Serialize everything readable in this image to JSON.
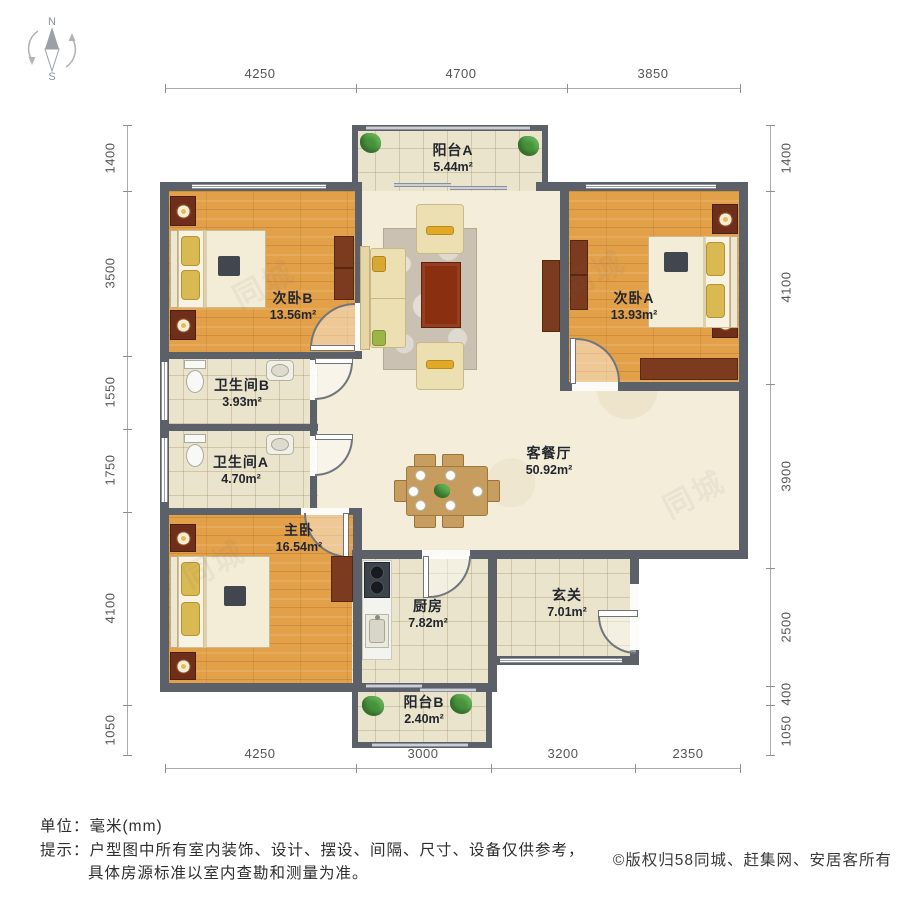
{
  "compass": {
    "north_label": "N",
    "south_label": "S"
  },
  "dimensions": {
    "top": [
      "4250",
      "4700",
      "3850"
    ],
    "bottom": [
      "4250",
      "3000",
      "3200",
      "2350"
    ],
    "left": [
      "1400",
      "3500",
      "1550",
      "1750",
      "4100",
      "1050"
    ],
    "right": [
      "1400",
      "4100",
      "3900",
      "2500",
      "400",
      "1050"
    ]
  },
  "rooms": {
    "balcony_a": {
      "name": "阳台A",
      "area": "5.44m²"
    },
    "bedroom_b": {
      "name": "次卧B",
      "area": "13.56m²"
    },
    "bedroom_a": {
      "name": "次卧A",
      "area": "13.93m²"
    },
    "bathroom_b": {
      "name": "卫生间B",
      "area": "3.93m²"
    },
    "bathroom_a": {
      "name": "卫生间A",
      "area": "4.70m²"
    },
    "living_dining": {
      "name": "客餐厅",
      "area": "50.92m²"
    },
    "master_bedroom": {
      "name": "主卧",
      "area": "16.54m²"
    },
    "kitchen": {
      "name": "厨房",
      "area": "7.82m²"
    },
    "entry": {
      "name": "玄关",
      "area": "7.01m²"
    },
    "balcony_b": {
      "name": "阳台B",
      "area": "2.40m²"
    }
  },
  "footer": {
    "unit_label": "单位：",
    "unit_value": "毫米(mm)",
    "tip_label": "提示：",
    "tip_line1": "户型图中所有室内装饰、设计、摆设、间隔、尺寸、设备仅供参考，",
    "tip_line2": "具体房源标准以室内查勘和测量为准。",
    "copyright": "©版权归58同城、赶集网、安居客所有"
  },
  "watermark": {
    "text": "同城"
  },
  "colors": {
    "wall": "#5c6069",
    "wood_floor": "#e2a049",
    "tile_floor": "#ebe4cc",
    "living_floor": "#f4edd9",
    "dark_furniture": "#7c3a1e"
  }
}
